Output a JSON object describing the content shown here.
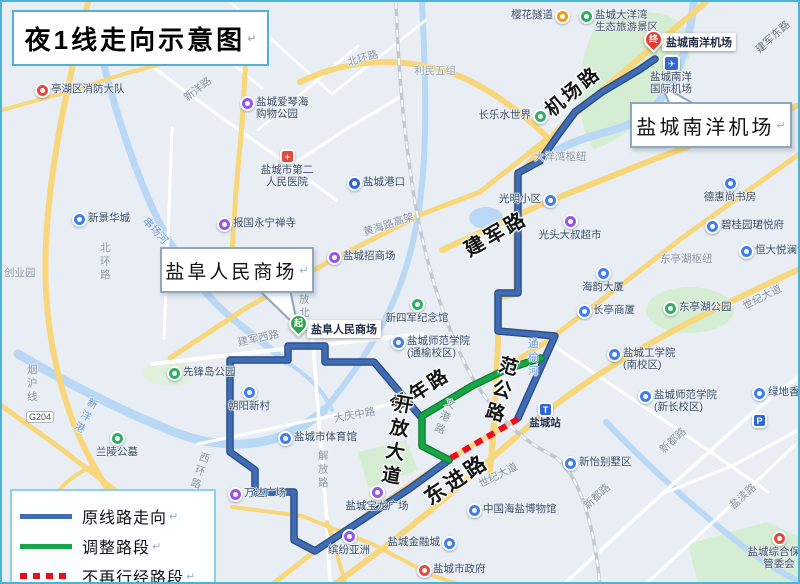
{
  "title": "夜1线走向示意图",
  "meta": {
    "return_mark": "↵"
  },
  "legend": {
    "items": [
      {
        "label": "原线路走向",
        "style": "blue-solid",
        "color": "#3f6cb5"
      },
      {
        "label": "调整路段",
        "style": "green-solid",
        "color": "#17a546"
      },
      {
        "label": "不再行经路段",
        "style": "red-dashed",
        "color": "#ea0d1e"
      }
    ]
  },
  "callouts": {
    "airport": "盐城南洋机场",
    "mall": "盐阜人民商场"
  },
  "markers": {
    "start": {
      "badge": "起",
      "label": "盐阜人民商场"
    },
    "end": {
      "badge": "终",
      "label": "盐城南洋机场"
    },
    "airport_poi": {
      "glyph": "✈",
      "label": "盐城南洋\n国际机场"
    }
  },
  "route_colors": {
    "original": "#3f6cb5",
    "adjusted": "#17a546",
    "removed": "#ea0d1e"
  },
  "major_roads": [
    {
      "text": "机场路"
    },
    {
      "text": "建军路"
    },
    {
      "text": "青年路"
    },
    {
      "text": "开放大道"
    },
    {
      "text": "范公路"
    },
    {
      "text": "东进路"
    }
  ],
  "minor_roads": [
    {
      "text": "北环路"
    },
    {
      "text": "北环路"
    },
    {
      "text": "利民五组"
    },
    {
      "text": "新洋路"
    },
    {
      "text": "黄海路高架"
    },
    {
      "text": "大洋湾枢纽"
    },
    {
      "text": "建军东路"
    },
    {
      "text": "大庆中路"
    },
    {
      "text": "解放路"
    },
    {
      "text": "解放北路"
    },
    {
      "text": "建军西路"
    },
    {
      "text": "西环路"
    },
    {
      "text": "烟沪线"
    },
    {
      "text": "世纪大道"
    },
    {
      "text": "世纪大道"
    },
    {
      "text": "新都路"
    },
    {
      "text": "新都路"
    },
    {
      "text": "盐渎路"
    },
    {
      "text": "文港路"
    },
    {
      "text": "东亭湖枢纽"
    },
    {
      "text": "G204"
    },
    {
      "text": "创业园"
    }
  ],
  "water_labels": [
    {
      "text": "串场河"
    },
    {
      "text": "新洋港"
    },
    {
      "text": "通榆河"
    }
  ],
  "pois": [
    {
      "name": "亭湖区消防大队"
    },
    {
      "name": "樱花隧道"
    },
    {
      "name": "盐城大洋湾\n生态旅游景区"
    },
    {
      "name": "盐城爱琴海\n购物公园"
    },
    {
      "name": "盐城市第二\n人民医院"
    },
    {
      "name": "盐城港口"
    },
    {
      "name": "盐城招商场"
    },
    {
      "name": "新景华城"
    },
    {
      "name": "报国永宁禅寺"
    },
    {
      "name": "德惠尚书房"
    },
    {
      "name": "碧桂园珺悦府"
    },
    {
      "name": "恒大悦澜湾"
    },
    {
      "name": "东亭湖公园"
    },
    {
      "name": "海韵大厦"
    },
    {
      "name": "长亭商厦"
    },
    {
      "name": "盐城工学院\n(南校区)"
    },
    {
      "name": "盐城师范学院\n(新长校区)"
    },
    {
      "name": "光明小区"
    },
    {
      "name": "光头大叔超市"
    },
    {
      "name": "新四军纪念馆"
    },
    {
      "name": "盐城师范学院\n(通榆校区)"
    },
    {
      "name": "盐城市体育馆"
    },
    {
      "name": "朝阳新村"
    },
    {
      "name": "万达广场"
    },
    {
      "name": "先锋岛公园"
    },
    {
      "name": "兰陵公墓"
    },
    {
      "name": "盐城站"
    },
    {
      "name": "新怡别墅区"
    },
    {
      "name": "中国海盐博物馆"
    },
    {
      "name": "盐城金融城"
    },
    {
      "name": "盐城市政府"
    },
    {
      "name": "盐城宝龙广场"
    },
    {
      "name": "缤纷亚洲"
    },
    {
      "name": "盐城综合保税\n管委会"
    },
    {
      "name": "长乐水世界"
    },
    {
      "name": "绿地香颂"
    },
    {
      "name": "P"
    }
  ]
}
